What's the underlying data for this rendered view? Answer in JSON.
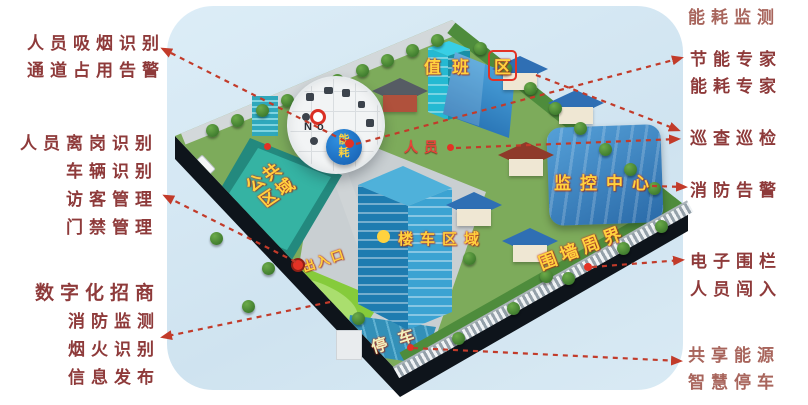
{
  "callouts": {
    "smoking": {
      "lines": [
        "人员吸烟识别",
        "通道占用告警"
      ]
    },
    "access": {
      "lines": [
        "人员离岗识别",
        "车辆识别",
        "访客管理",
        "门禁管理"
      ]
    },
    "invest": {
      "lines": [
        "数字化招商",
        "消防监测",
        "烟火识别",
        "信息发布"
      ]
    },
    "energy_monitor": {
      "lines": [
        "能耗监测"
      ]
    },
    "energy_expert": {
      "lines": [
        "节能专家",
        "能耗专家"
      ]
    },
    "patrol": {
      "lines": [
        "巡查巡检"
      ]
    },
    "fire_alarm": {
      "lines": [
        "消防告警"
      ]
    },
    "fence": {
      "lines": [
        "电子围栏",
        "人员闯入"
      ]
    },
    "shared": {
      "lines": [
        "共享能源",
        "智慧停车"
      ]
    }
  },
  "map": {
    "duty_area": {
      "prefix": "值班",
      "boxed": "区"
    },
    "personnel": "人员",
    "energy_badge": {
      "top": "能",
      "bottom": "耗"
    },
    "monitor_center": "监控中心",
    "building_vehicle_area": "楼车区域",
    "perimeter": "围墙周界",
    "entrance": "出入口",
    "parking": "停车",
    "public_area": {
      "lines": [
        "公共",
        "区域"
      ]
    },
    "magnifier_label": "No"
  },
  "colors": {
    "callout_red": "#8e3a3a",
    "callout_muted": "#a8655c",
    "arrow": "#c23b2a",
    "map_label_yellow": "#ffd23f"
  },
  "arrows": [
    {
      "name": "energy-to-smoking",
      "from": [
        345,
        141
      ],
      "to": [
        163,
        49
      ]
    },
    {
      "name": "entrance-to-access",
      "from": [
        296,
        262
      ],
      "to": [
        165,
        196
      ]
    },
    {
      "name": "lawn-to-smoke-fire",
      "from": [
        330,
        302
      ],
      "to": [
        163,
        337
      ]
    },
    {
      "name": "energy-to-expert",
      "from": [
        356,
        144
      ],
      "to": [
        681,
        58
      ]
    },
    {
      "name": "duty-to-patrol",
      "from": [
        536,
        75
      ],
      "to": [
        678,
        130
      ]
    },
    {
      "name": "personnel-to-patrol",
      "from": [
        456,
        148
      ],
      "to": [
        678,
        139
      ]
    },
    {
      "name": "monitor-to-fire-alarm",
      "from": [
        652,
        186
      ],
      "to": [
        685,
        187
      ]
    },
    {
      "name": "perimeter-to-fence",
      "from": [
        592,
        267
      ],
      "to": [
        682,
        260
      ]
    },
    {
      "name": "parking-to-shared",
      "from": [
        413,
        348
      ],
      "to": [
        680,
        361
      ]
    }
  ]
}
